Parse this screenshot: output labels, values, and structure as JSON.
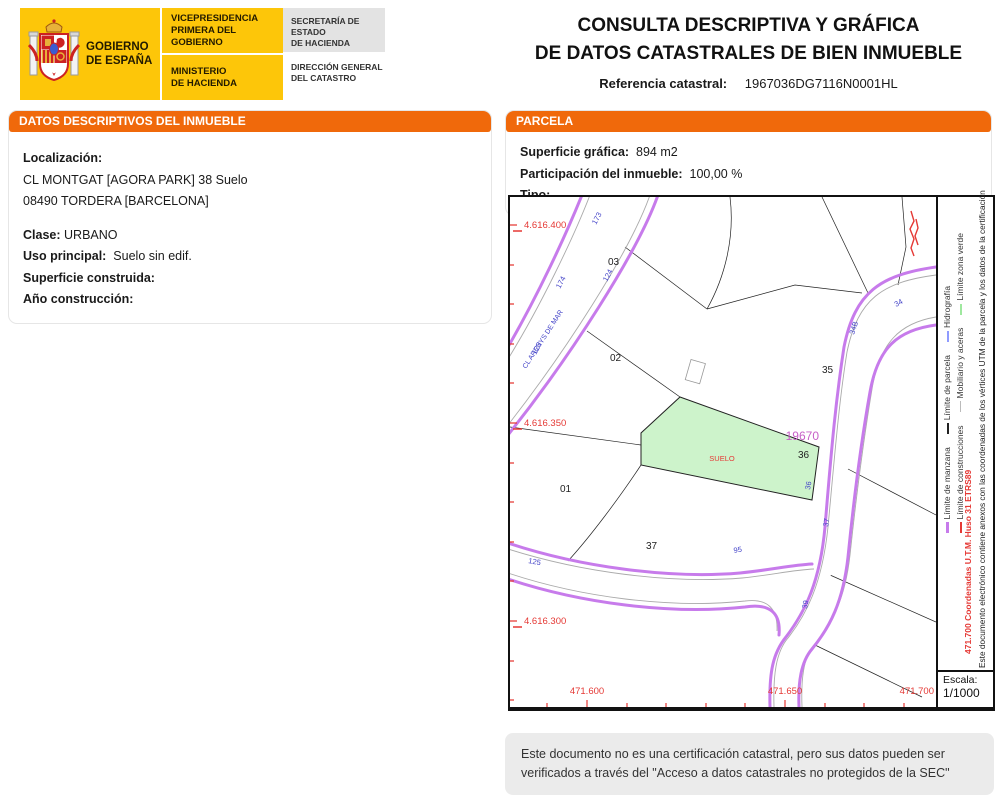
{
  "header": {
    "logo": {
      "gobierno_line1": "GOBIERNO",
      "gobierno_line2": "DE ESPAÑA",
      "vice_line1": "VICEPRESIDENCIA",
      "vice_line2": "PRIMERA DEL GOBIERNO",
      "ministerio_line1": "MINISTERIO",
      "ministerio_line2": "DE HACIENDA",
      "secretaria_line1": "SECRETARÍA DE ESTADO",
      "secretaria_line2": "DE HACIENDA",
      "direccion_line1": "DIRECCIÓN GENERAL",
      "direccion_line2": "DEL CATASTRO"
    },
    "title_line1": "CONSULTA DESCRIPTIVA Y GRÁFICA",
    "title_line2": "DE DATOS CATASTRALES DE BIEN INMUEBLE",
    "ref_label": "Referencia catastral:",
    "ref_value": "1967036DG7116N0001HL"
  },
  "inmueble": {
    "section_title": "DATOS DESCRIPTIVOS DEL INMUEBLE",
    "localizacion_label": "Localización:",
    "address_line1": "CL MONTGAT [AGORA PARK] 38 Suelo",
    "address_line2": "08490 TORDERA [BARCELONA]",
    "clase_label": "Clase:",
    "clase_value": "URBANO",
    "uso_label": "Uso principal:",
    "uso_value": "Suelo sin edif.",
    "superficie_label": "Superficie construida:",
    "superficie_value": "",
    "anio_label": "Año construcción:",
    "anio_value": ""
  },
  "parcela": {
    "section_title": "PARCELA",
    "superficie_label": "Superficie gráfica:",
    "superficie_value": "894 m2",
    "participacion_label": "Participación del inmueble:",
    "participacion_value": "100,00 %",
    "tipo_label": "Tipo:",
    "tipo_value": ""
  },
  "map": {
    "y_axis_labels": [
      "4.616.400",
      "4.616.350",
      "4.616.300"
    ],
    "x_axis_labels": [
      "471.600",
      "471.650",
      "471.700"
    ],
    "parcel_numbers": {
      "p01": "01",
      "p02": "02",
      "p03": "03",
      "p35": "35",
      "p36": "36",
      "p37": "37"
    },
    "street_name": "CL ARENYS DE MAR",
    "street_numbers": {
      "n173": "173",
      "n174": "174",
      "n124": "124",
      "n123": "123",
      "n125": "125",
      "n95": "95",
      "n34": "34",
      "n34b": "34B",
      "n36": "36",
      "n37": "37",
      "n39": "39"
    },
    "highlighted_parcel": {
      "label": "SUELO",
      "id": "19670"
    },
    "scale_label": "Escala:",
    "scale_value": "1/1000",
    "margin_coordinates_text": "471.700 Coordenadas U.T.M. Huso 31 ETRS89",
    "margin_note": "Este documento electrónico contiene anexos con las coordenadas de los vértices UTM de la parcela y los datos de la certificación",
    "legend": {
      "items": [
        {
          "label": "Límite de manzana",
          "color": "#c77beb"
        },
        {
          "label": "Límite de parcela",
          "color": "#222222"
        },
        {
          "label": "Hidrografía",
          "color": "#8f9bff"
        },
        {
          "label": "Límite de construcciones",
          "color": "#e53935"
        },
        {
          "label": "Mobiliario y aceras",
          "color": "#bbbbbb"
        },
        {
          "label": "Límite zona verde",
          "color": "#9fe89f"
        }
      ]
    }
  },
  "footer": {
    "disclaimer": "Este documento no es una certificación catastral, pero sus datos pueden ser verificados a través del \"Acceso a datos catastrales no protegidos de la SEC\""
  },
  "colors": {
    "accent_orange": "#f0690b",
    "logo_yellow": "#fdc609",
    "parcel_green": "#cdf3cb",
    "road_purple": "#c77beb",
    "coordinate_red": "#e53935",
    "number_blue": "#4343c8",
    "parcel_id_purple": "#c75fc7"
  }
}
